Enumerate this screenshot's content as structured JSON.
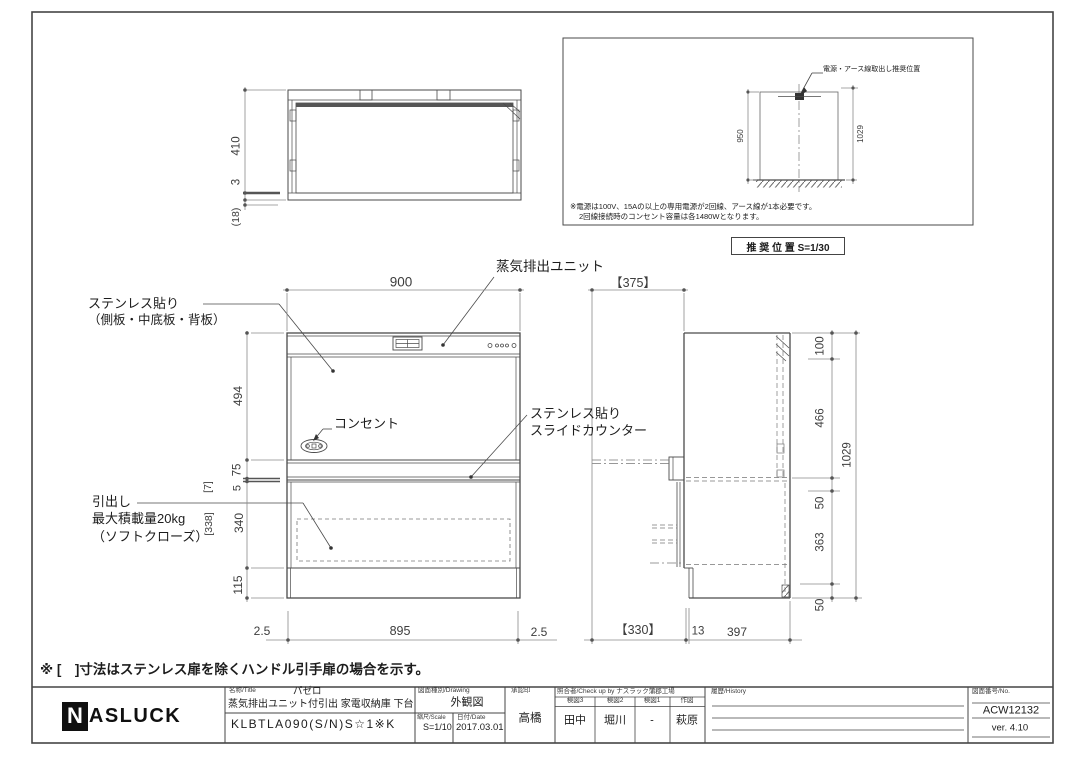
{
  "note": "※ [　]寸法はステンレス扉を除くハンドル引手扉の場合を示す。",
  "plan": {
    "d410": "410",
    "d3": "3",
    "d18": "(18)"
  },
  "rec": {
    "leader": "電源・アース線取出し推奨位置",
    "note1": "※電源は100V、15Aの以上の専用電源が2回線、アース線が1本必要です。",
    "note2": "2回線接続時のコンセント容量は各1480Wとなります。",
    "caption": "推 奨 位 置 S=1/30",
    "d950": "950",
    "d1029": "1029"
  },
  "front": {
    "d900": "900",
    "d494": "494",
    "d75": "75",
    "d5": "5",
    "d340": "340",
    "d115": "115",
    "b7": "[7]",
    "b338": "[338]",
    "d25l": "2.5",
    "d895": "895",
    "d25r": "2.5",
    "steam": "蒸気排出ユニット",
    "stainless1": "ステンレス貼り",
    "stainless2": "（側板・中底板・背板）",
    "outlet": "コンセント",
    "counter1": "ステンレス貼り",
    "counter2": "スライドカウンター",
    "drawer1": "引出し",
    "drawer2": "最大積載量20kg",
    "drawer3": "（ソフトクローズ）"
  },
  "side": {
    "d375": "【375】",
    "d100": "100",
    "d466": "466",
    "d50a": "50",
    "d363": "363",
    "d50b": "50",
    "d1029": "1029",
    "d330": "【330】",
    "d13": "13",
    "d397": "397"
  },
  "title_block": {
    "brand_n": "N",
    "brand_rest": "ASLUCK",
    "name_label": "名称/Title",
    "series": "パゼロ",
    "product": "蒸気排出ユニット付引出 家電収納庫 下台",
    "model": "KLBTLA090(S/N)S☆1※K",
    "drawing_label": "図面種別/Drawing",
    "drawing_type": "外観図",
    "scale_label": "縮尺/Scale",
    "scale": "S=1/10",
    "date_label": "日付/Date",
    "date": "2017.03.01",
    "approval_label": "承認印",
    "approval": "高橋",
    "check_label": "照合者/Check up by ナスラック蒲郡工場",
    "check_cols": [
      "検図3",
      "検図2",
      "検図1",
      "作図"
    ],
    "check_vals": [
      "田中",
      "堀川",
      "-",
      "萩原"
    ],
    "history_label": "履歴/History",
    "no_label": "図面番号/No.",
    "no": "ACW12132",
    "version": "ver. 4.10"
  }
}
